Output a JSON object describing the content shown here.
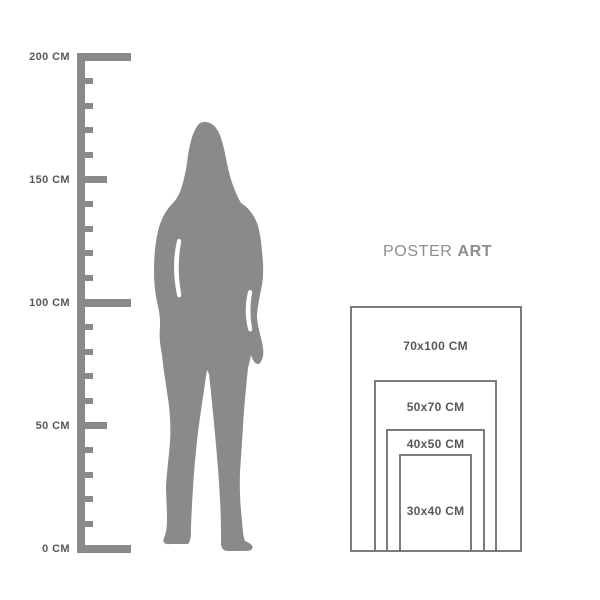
{
  "ruler": {
    "unit_labels": [
      {
        "text": "200 CM",
        "cm": 200
      },
      {
        "text": "150 CM",
        "cm": 150
      },
      {
        "text": "100 CM",
        "cm": 100
      },
      {
        "text": "50 CM",
        "cm": 50
      },
      {
        "text": "0 CM",
        "cm": 0
      }
    ],
    "max_cm": 200,
    "tick_interval_cm": 10,
    "color": "#8a8a8b",
    "label_color": "#58585a"
  },
  "figure": {
    "description": "standing woman silhouette",
    "color": "#8a8a8b"
  },
  "brand": {
    "title_regular": "POSTER",
    "title_bold": "ART",
    "color": "#8e8e90"
  },
  "size_chart": {
    "border_color": "#7b7b7d",
    "label_color": "#58585a",
    "sizes": [
      {
        "label": "70x100 CM",
        "width_cm": 70,
        "height_cm": 100
      },
      {
        "label": "50x70 CM",
        "width_cm": 50,
        "height_cm": 70
      },
      {
        "label": "40x50 CM",
        "width_cm": 40,
        "height_cm": 50
      },
      {
        "label": "30x40 CM",
        "width_cm": 30,
        "height_cm": 40
      }
    ]
  }
}
